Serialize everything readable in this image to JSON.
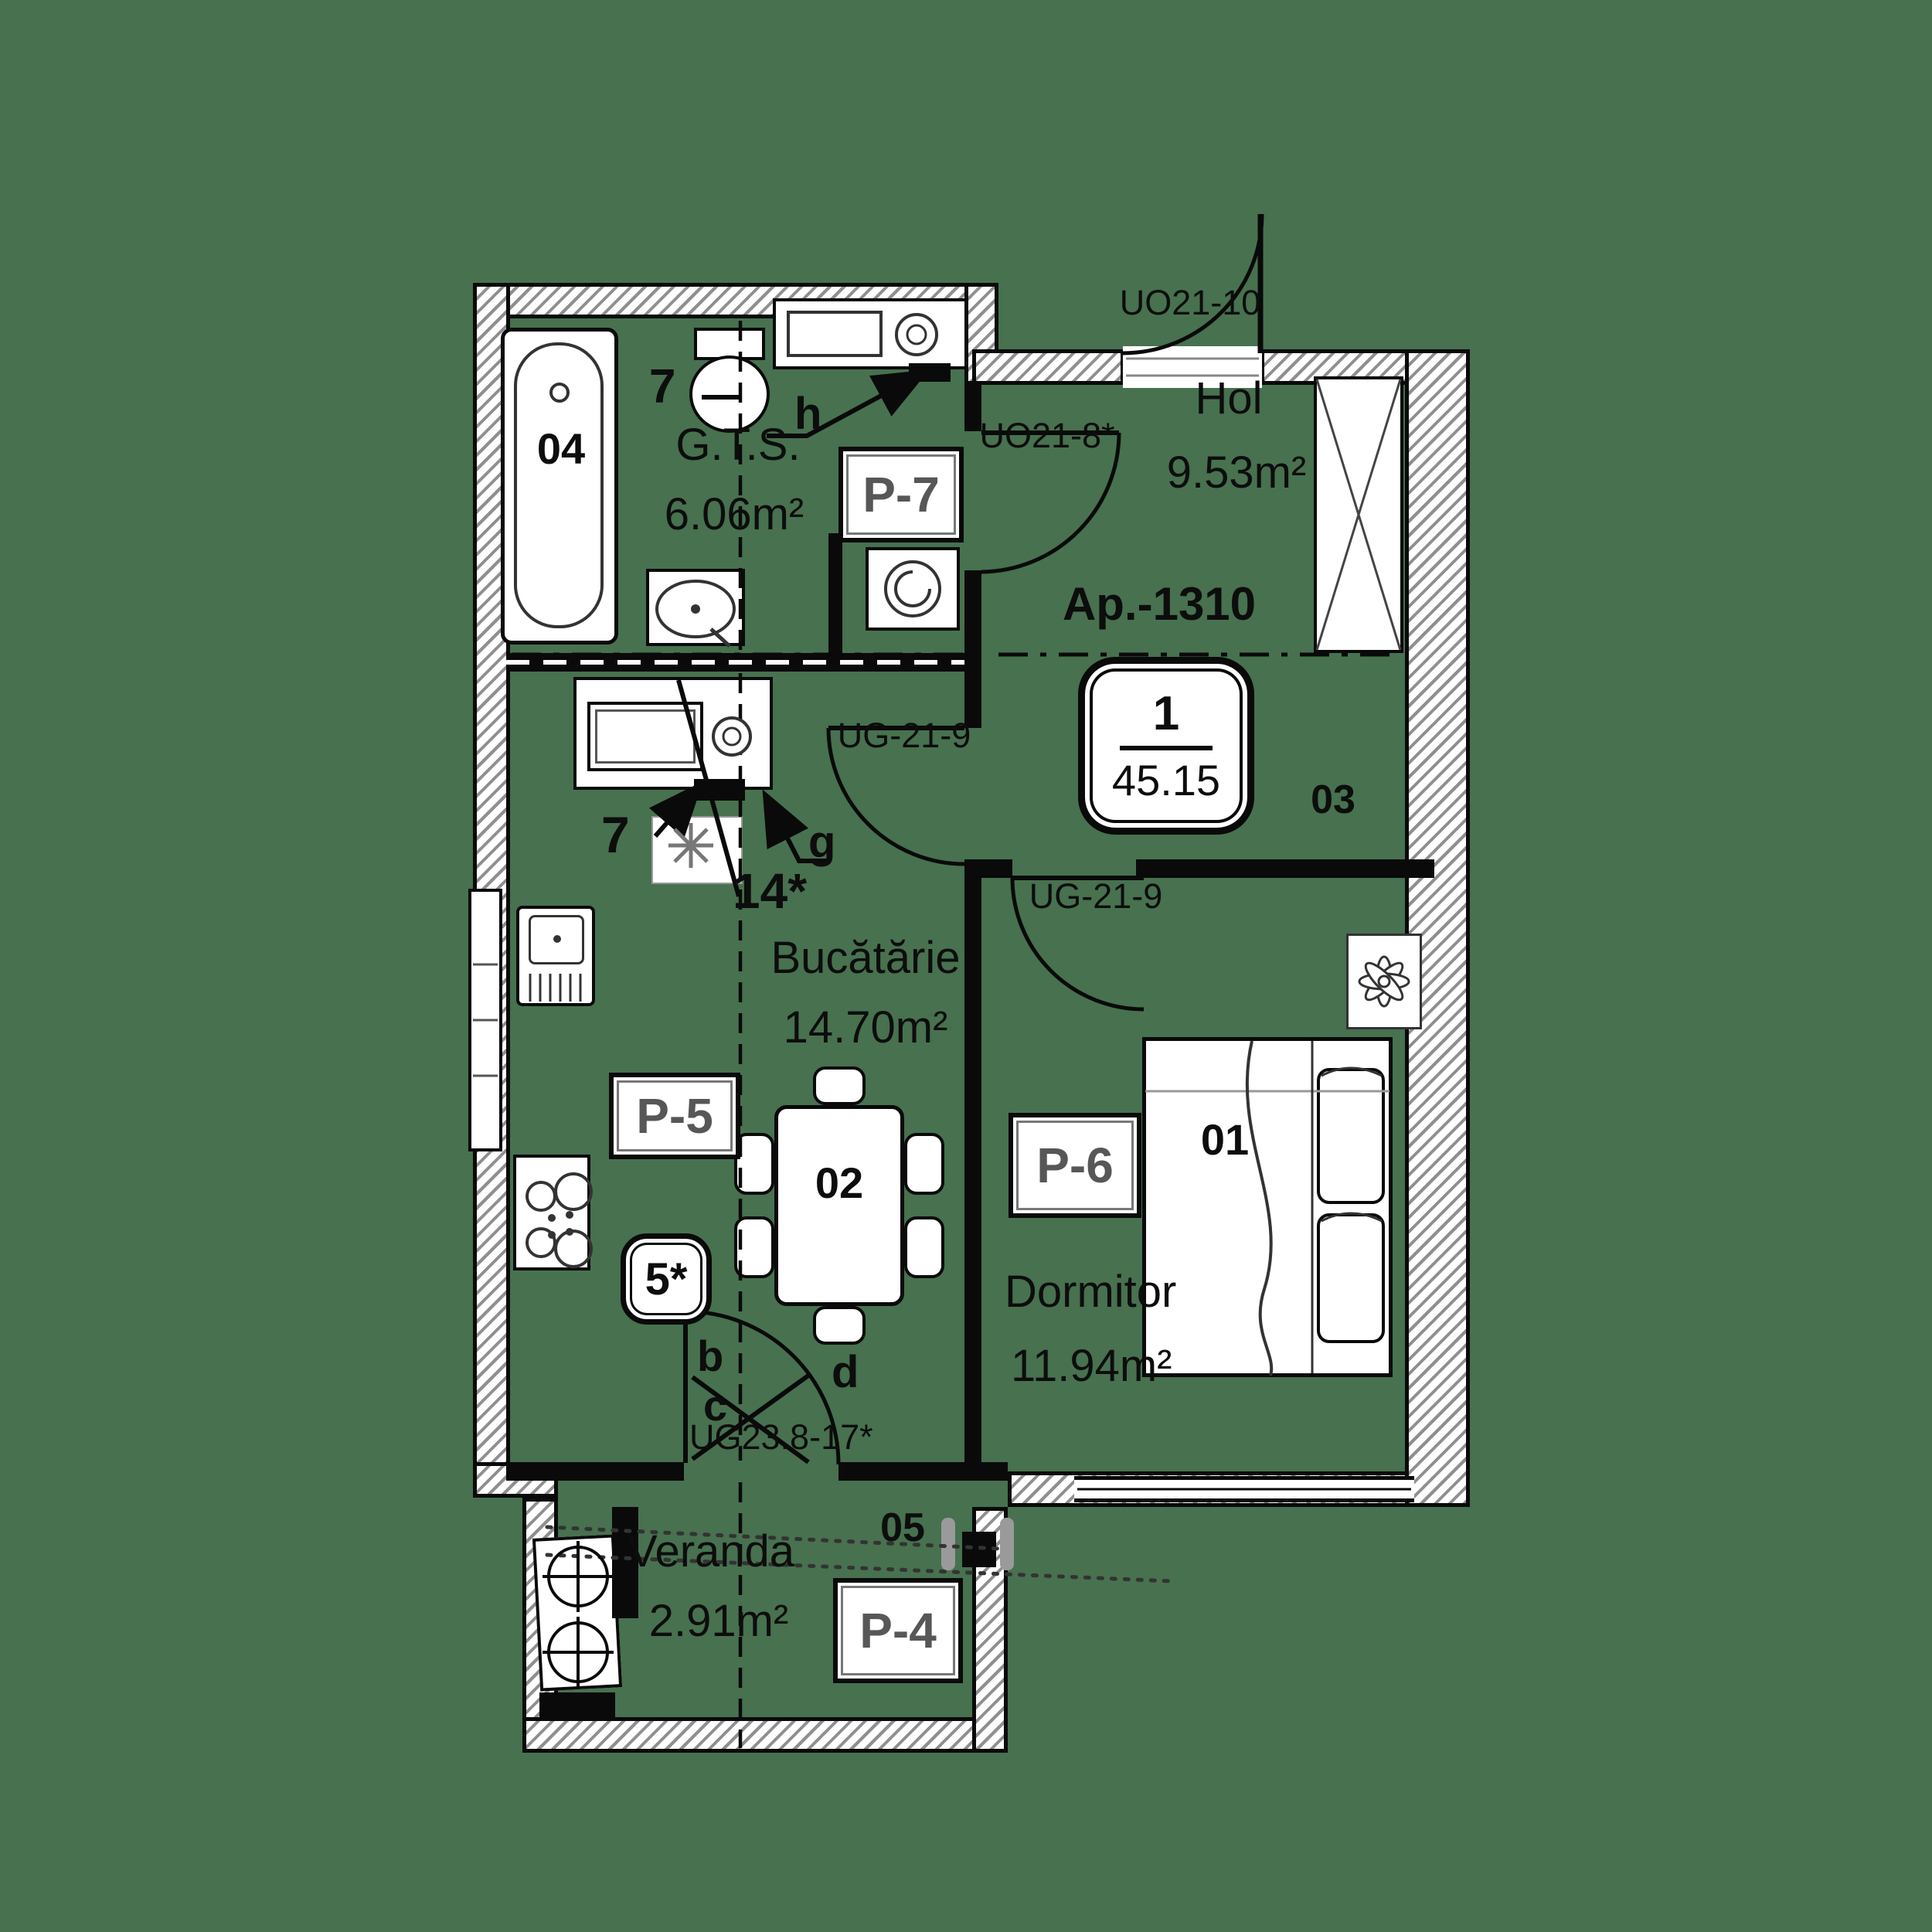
{
  "apartment": {
    "code": "Ap.-1310",
    "badge_top": "1",
    "badge_bottom": "45.15"
  },
  "rooms": [
    {
      "name": "Hol",
      "area": "9.53m²",
      "number": "03"
    },
    {
      "name": "G.T.S.",
      "area": "6.06m²",
      "number": "04"
    },
    {
      "name": "Bucătărie",
      "area": "14.70m²",
      "number": "02"
    },
    {
      "name": "Dormitor",
      "area": "11.94m²",
      "number": "01"
    },
    {
      "name": "Veranda",
      "area": "2.91m²",
      "number": "05"
    }
  ],
  "doors": {
    "entrance": "UO21-10",
    "bathroom": "UO21-8*",
    "kitchen": "UG-21-9",
    "bedroom": "UG-21-9",
    "veranda": "UG23.8-17*"
  },
  "parapets": {
    "p4": "P-4",
    "p5": "P-5",
    "p6": "P-6",
    "p7": "P-7"
  },
  "marks": {
    "toilet": "7",
    "boiler": "7",
    "vent": "14*",
    "hob": "5*",
    "hood": "g",
    "vent_h": "h",
    "riser_b": "b",
    "riser_c": "c",
    "riser_d": "d"
  },
  "colors": {
    "background": "#47714F",
    "line": "#0a0a0a",
    "code_text": "#575757",
    "hatch": "#8f8f8f"
  }
}
